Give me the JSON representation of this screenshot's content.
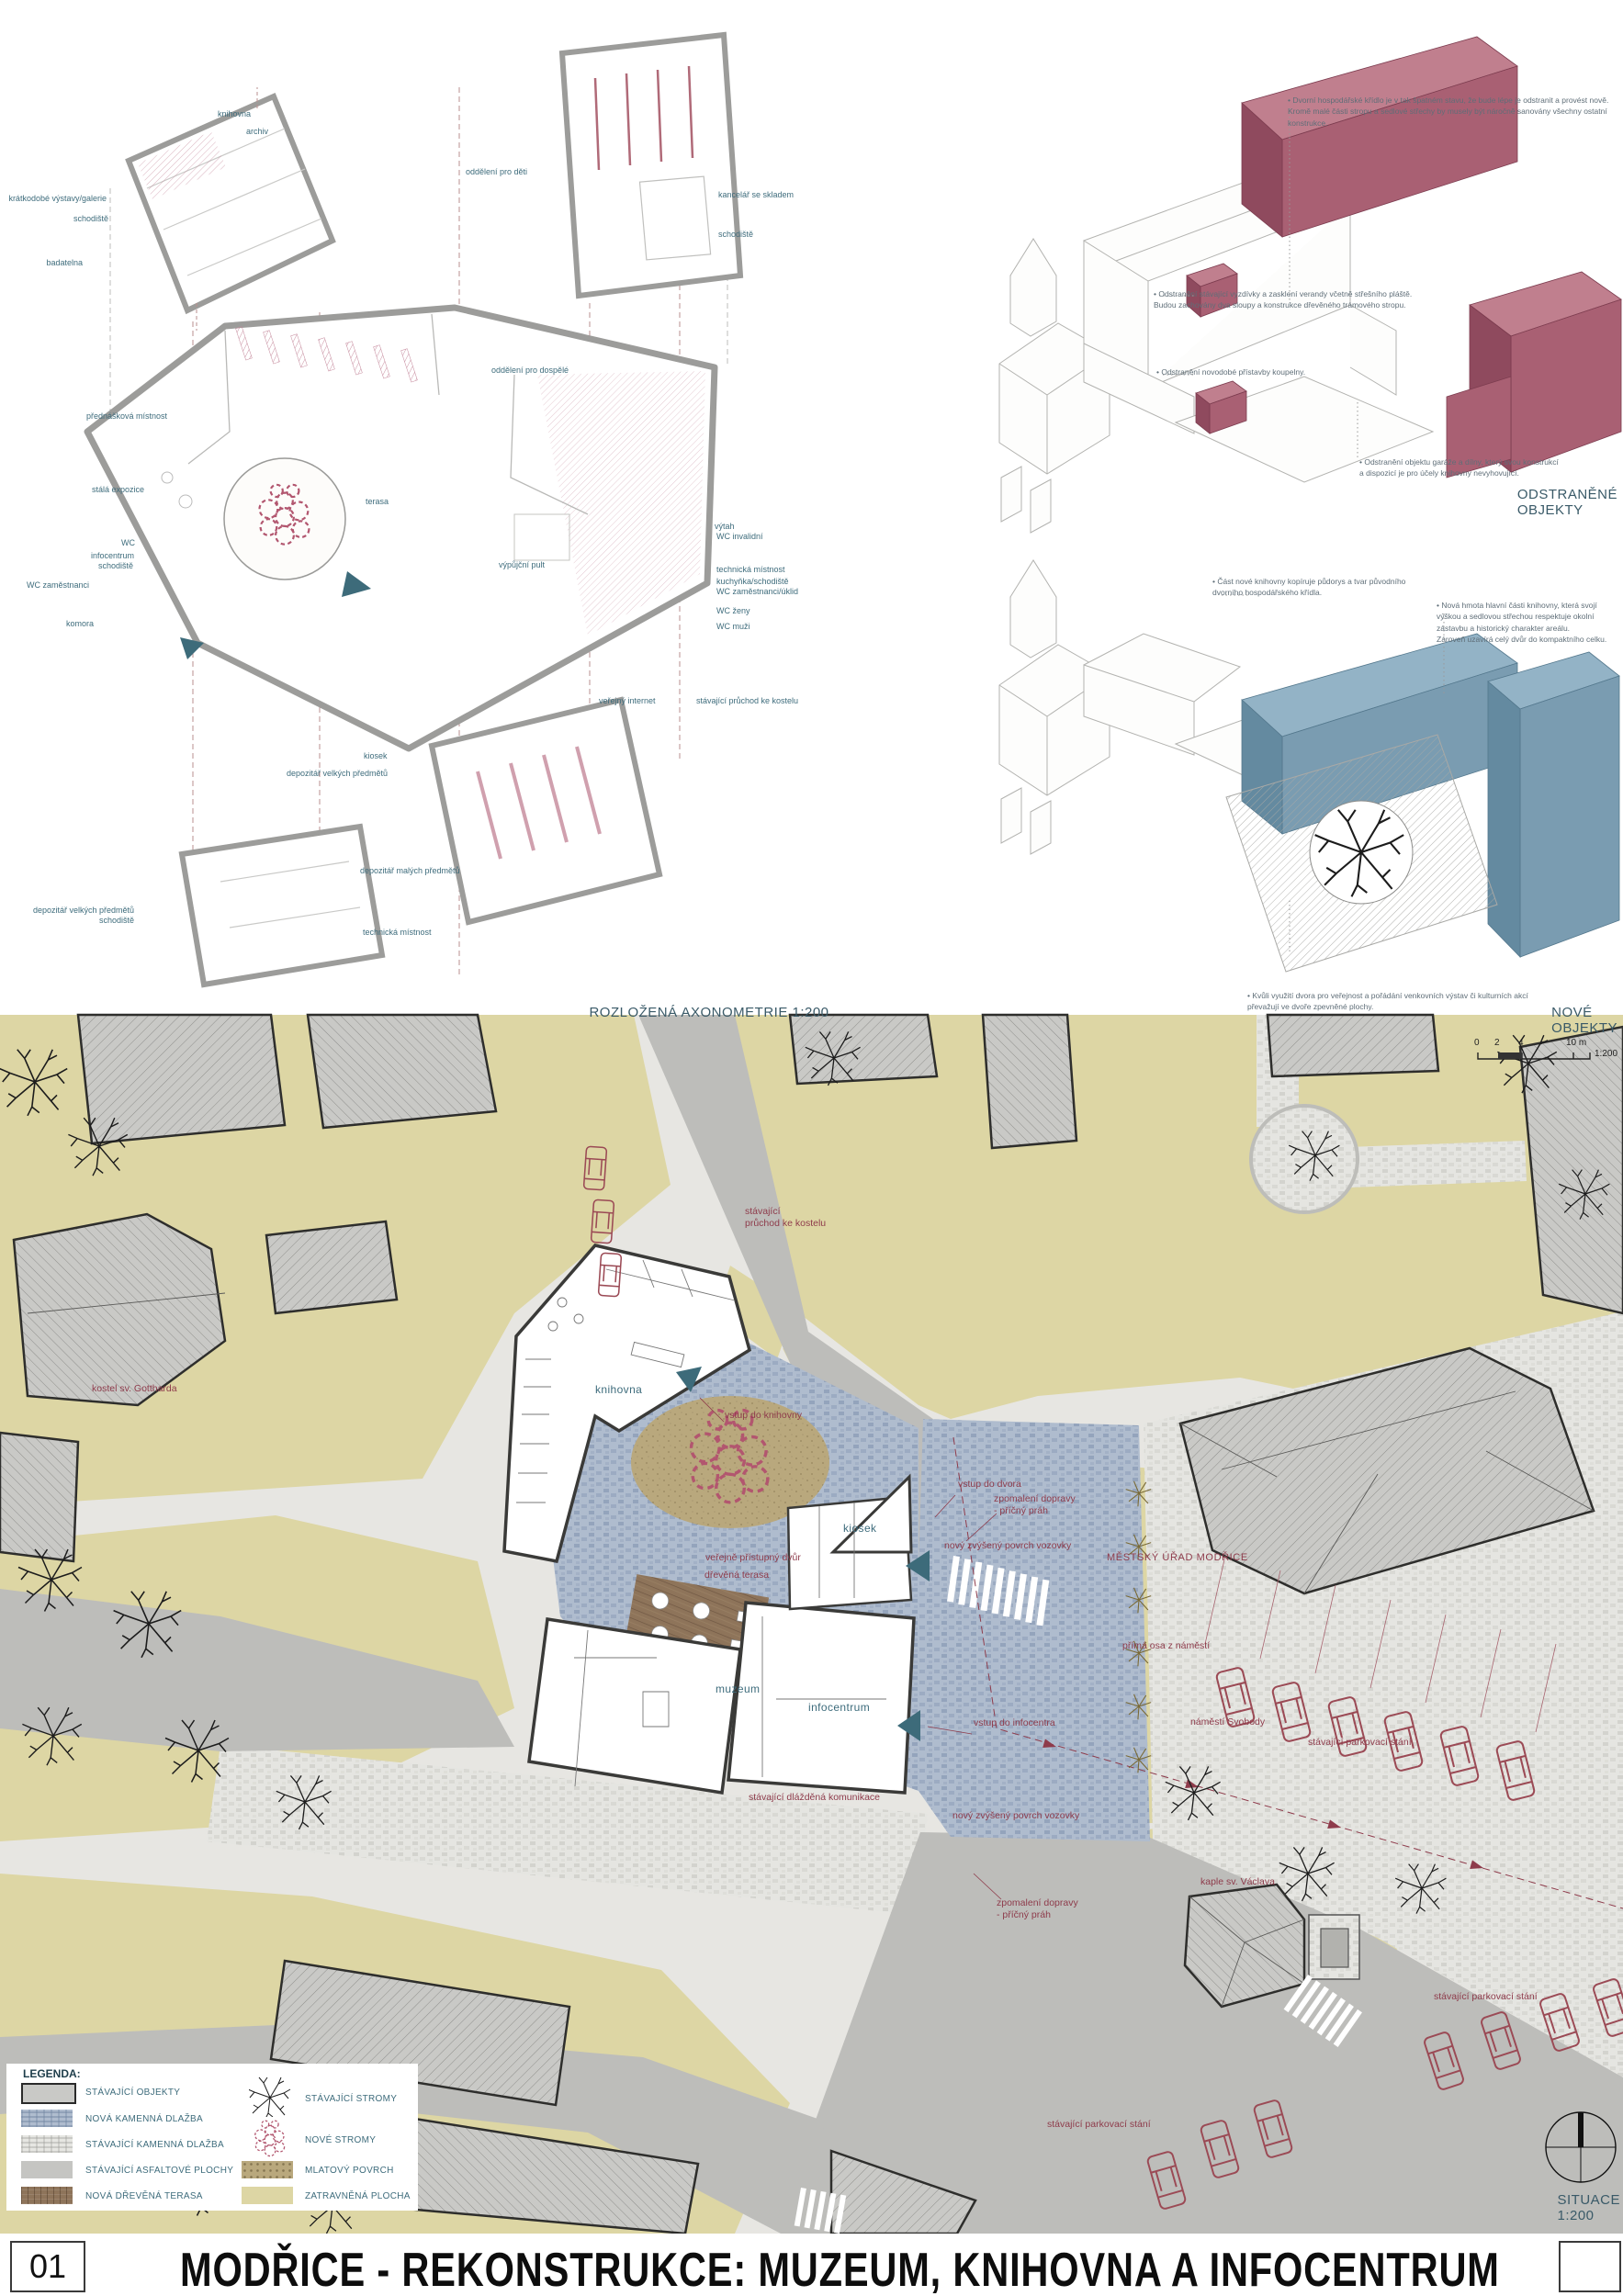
{
  "board": {
    "sheet_number": "01",
    "title": "MODŘICE - REKONSTRUKCE: MUZEUM, KNIHOVNA A INFOCENTRUM"
  },
  "axonometry": {
    "caption": "ROZLOŽENÁ AXONOMETRIE 1:200",
    "labels": [
      "knihovna",
      "archiv",
      "krátkodobé výstavy/galerie",
      "schodiště",
      "badatelna",
      "oddělení pro děti",
      "kancelář se skladem",
      "schodiště",
      "přednášková místnost",
      "stálá expozice",
      "WC",
      "infocentrum",
      "schodiště",
      "WC zaměstnanci",
      "komora",
      "oddělení pro dospělé",
      "terasa",
      "výpůjční pult",
      "výtah",
      "WC invalidní",
      "technická místnost",
      "kuchyňka/schodiště",
      "WC zaměstnanci/úklid",
      "WC ženy",
      "WC muži",
      "veřejný internet",
      "stávající průchod ke kostelu",
      "kiosek",
      "depozitář velkých předmětů",
      "depozitář malých předmětů",
      "depozitář velkých předmětů",
      "schodiště",
      "technická místnost"
    ]
  },
  "removed": {
    "caption": "ODSTRANĚNÉ OBJEKTY",
    "notes": [
      "• Dvorní hospodářské křídlo je v tak špatném stavu, že bude lépe je odstranit a provést nově.\nKromě malé části stropu a sedlové střechy by musely být náročně sanovány všechny ostatní konstrukce.",
      "• Odstranění stávající vyzdívky a zasklení verandy včetně střešního pláště.\nBudou zachovány dva sloupy a konstrukce dřevěného trámového stropu.",
      "• Odstranění novodobé přístavby koupelny.",
      "• Odstranění objektu garáže a dílny, který svou konstrukcí\na dispozicí je pro účely knihovny nevyhovující."
    ]
  },
  "new_objects": {
    "caption": "NOVÉ OBJEKTY",
    "notes": [
      "• Část nové knihovny kopíruje půdorys a tvar původního\ndvorního hospodářského křídla.",
      "• Nová hmota hlavní části knihovny, která svojí\nvýškou a sedlovou střechou respektuje okolní\nzástavbu a historický charakter areálu.\nZároveň uzavírá celý dvůr do kompaktního celku.",
      "• Kvůli využití dvora pro veřejnost a pořádání venkovních výstav či kulturních akcí\npřevažují ve dvoře zpevněné plochy."
    ]
  },
  "siteplan": {
    "caption": "SITUACE 1:200",
    "scalebar": {
      "ticks": [
        "0",
        "2",
        "4",
        "10 m"
      ],
      "ratio": "1:200"
    },
    "labels": [
      "stávající\nprůchod ke kostelu",
      "knihovna",
      "vstup do knihovny",
      "vstup do dvora",
      "zpomalení dopravy\n- příčný práh",
      "nový zvýšený povrch vozovky",
      "kiosek",
      "veřejně přístupný dvůr",
      "dřevěná terasa",
      "muzeum",
      "infocentrum",
      "vstup do infocentra",
      "MĚSTSKÝ ÚŘAD MODŘICE",
      "přímá osa z náměstí",
      "náměstí Svobody",
      "stávající parkovací stání",
      "stávající dlážděná komunikace",
      "nový zvýšený povrch vozovky",
      "zpomalení dopravy\n- příčný práh",
      "kaple sv. Václava",
      "stávající parkovací stání",
      "stávající parkovací stání",
      "kostel sv. Gottharda"
    ]
  },
  "legend": {
    "title": "LEGENDA:",
    "items_left": [
      "STÁVAJÍCÍ OBJEKTY",
      "NOVÁ KAMENNÁ DLAŽBA",
      "STÁVAJÍCÍ KAMENNÁ DLAŽBA",
      "STÁVAJÍCÍ ASFALTOVÉ PLOCHY",
      "NOVÁ DŘEVĚNÁ TERASA"
    ],
    "items_right": [
      "STÁVAJÍCÍ STROMY",
      "NOVÉ STROMY",
      "MLATOVÝ POVRCH",
      "ZATRAVNĚNÁ PLOCHA"
    ]
  },
  "colors": {
    "label_teal": "#3e6c7c",
    "label_red": "#8e3b4b",
    "removed_fill": "#a96073",
    "new_fill": "#7a9cb1",
    "grass": "#ddd6a4",
    "new_paving": "#afbcce",
    "old_paving": "#e6e6e2",
    "asphalt": "#bdbdba",
    "wood": "#8e745a",
    "mlat": "#b9a87d"
  }
}
